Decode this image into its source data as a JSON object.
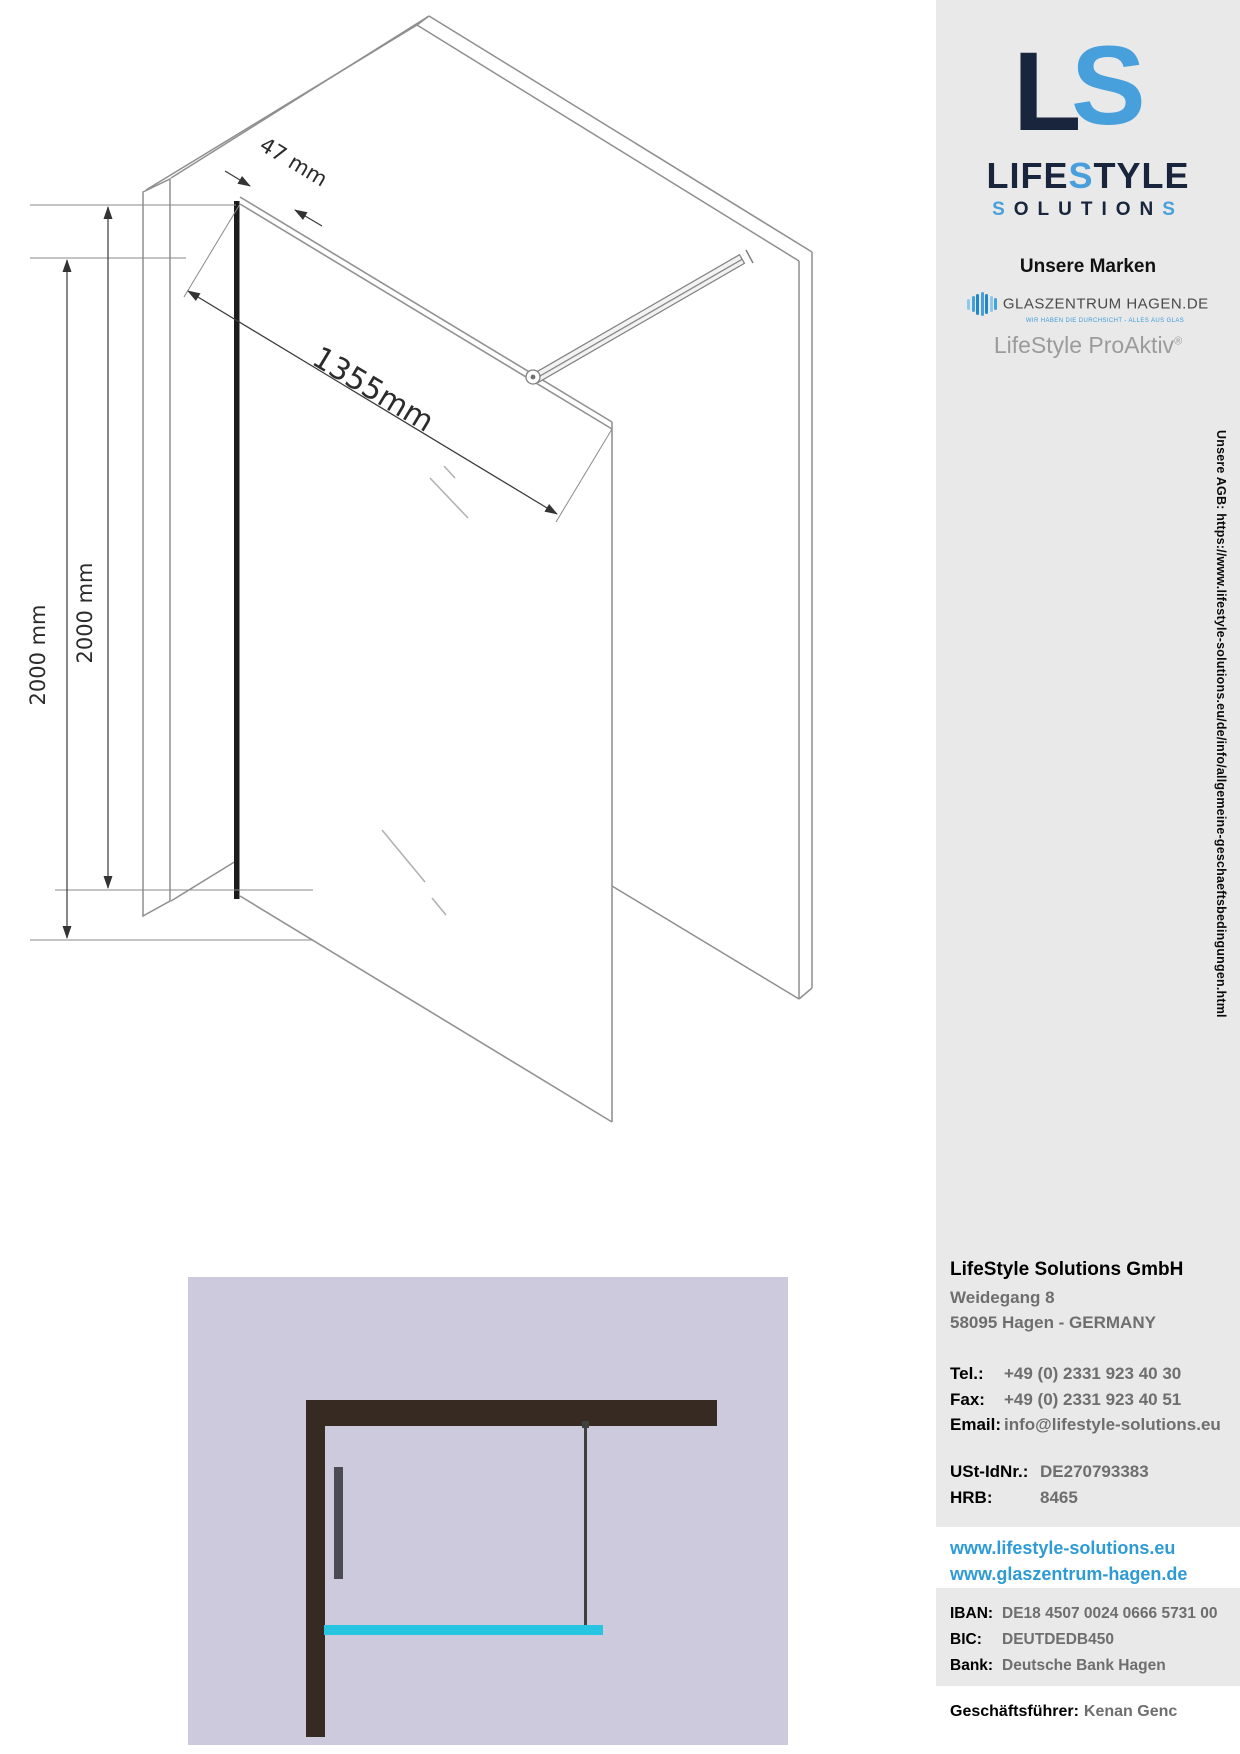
{
  "drawing": {
    "dim_thickness": "47 mm",
    "dim_width": "1355mm",
    "dim_height_outer": "2000 mm",
    "dim_height_inner": "2000 mm"
  },
  "sidebar": {
    "logo": {
      "mark_l": "L",
      "mark_s": "S",
      "word1_part1": "LIFE",
      "word1_part2": "S",
      "word1_part3": "TYLE",
      "word2_part1": "S",
      "word2_part2": "OLUTION",
      "word2_part3": "S"
    },
    "brands_title": "Unsere Marken",
    "glaszentrum": {
      "name": "GLASZENTRUM HAGEN.DE",
      "tagline": "WIR HABEN DIE DURCHSICHT - ALLES AUS GLAS"
    },
    "proaktiv": "LifeStyle ProAktiv",
    "proaktiv_reg": "®",
    "agb_link": "Unsere AGB: https://www.lifestyle-solutions.eu/de/info/allgemeine-geschaeftsbedingungen.html",
    "company": {
      "name": "LifeStyle Solutions GmbH",
      "street": "Weidegang 8",
      "city": "58095 Hagen - GERMANY",
      "tel_label": "Tel.:",
      "tel_value": "+49 (0) 2331 923 40 30",
      "fax_label": "Fax:",
      "fax_value": "+49 (0) 2331 923 40 51",
      "email_label": "Email:",
      "email_value": "info@lifestyle-solutions.eu",
      "ust_label": "USt-IdNr.:",
      "ust_value": "DE270793383",
      "hrb_label": "HRB:",
      "hrb_value": "8465",
      "web1": "www.lifestyle-solutions.eu",
      "web2": "www.glaszentrum-hagen.de",
      "iban_label": "IBAN:",
      "iban_value": "DE18 4507 0024 0666 5731 00",
      "bic_label": "BIC:",
      "bic_value": "DEUTDEDB450",
      "bank_label": "Bank:",
      "bank_value": "Deutsche Bank Hagen",
      "ceo_label": "Geschäftsführer:",
      "ceo_value": "Kenan Genc"
    }
  },
  "colors": {
    "navy": "#18253c",
    "logo_blue": "#47a0dc",
    "link_blue": "#2e9bd5",
    "sidebar_gray": "#e9e9e9",
    "lavender": "#cecade",
    "wall_dark": "#362a23",
    "glass_cyan": "#27c5e2"
  }
}
